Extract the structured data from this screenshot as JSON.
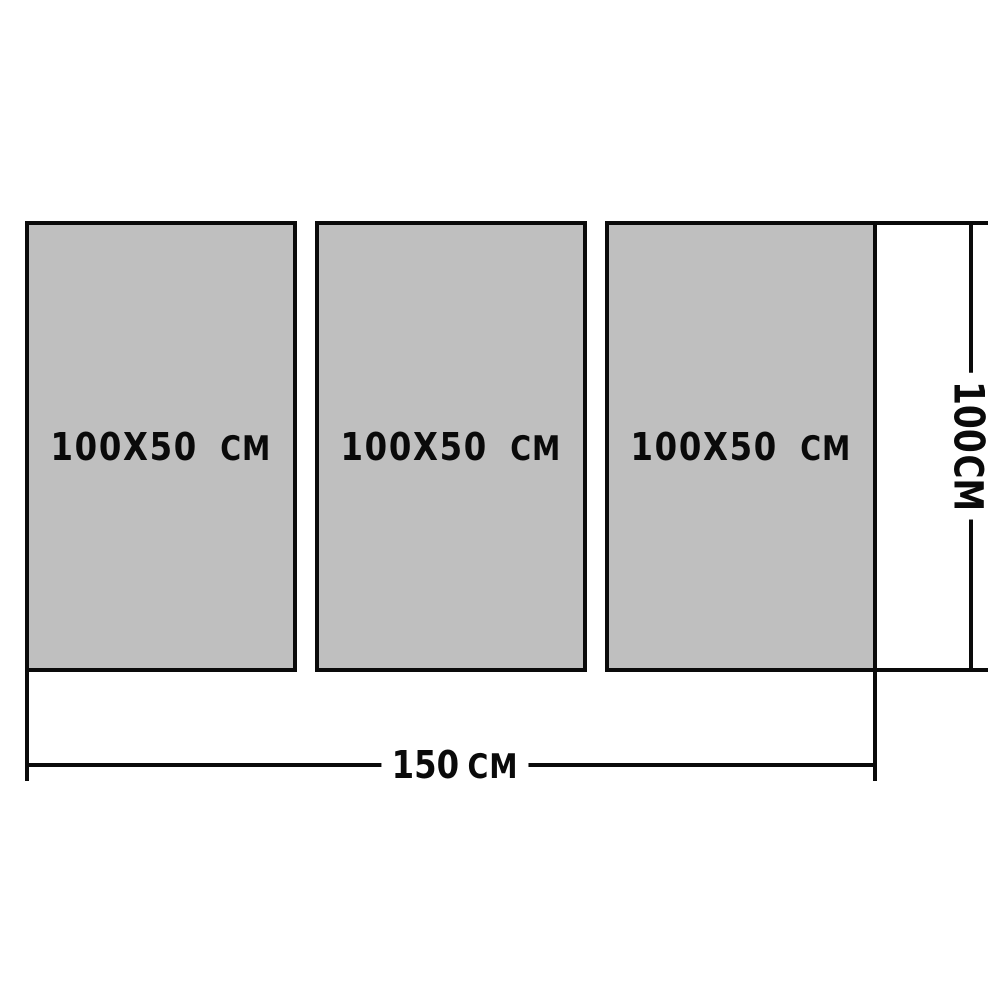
{
  "diagram": {
    "type": "product-size-diagram",
    "background_color": "#ffffff",
    "panel_fill_color": "#bfbfbf",
    "line_color": "#0a0a0a",
    "panels": [
      {
        "size": "100X50",
        "unit": "CM"
      },
      {
        "size": "100X50",
        "unit": "CM"
      },
      {
        "size": "100X50",
        "unit": "CM"
      }
    ],
    "width_dimension": {
      "value": "150",
      "unit": "CM"
    },
    "height_dimension": {
      "value": "100",
      "unit": "CM"
    }
  }
}
